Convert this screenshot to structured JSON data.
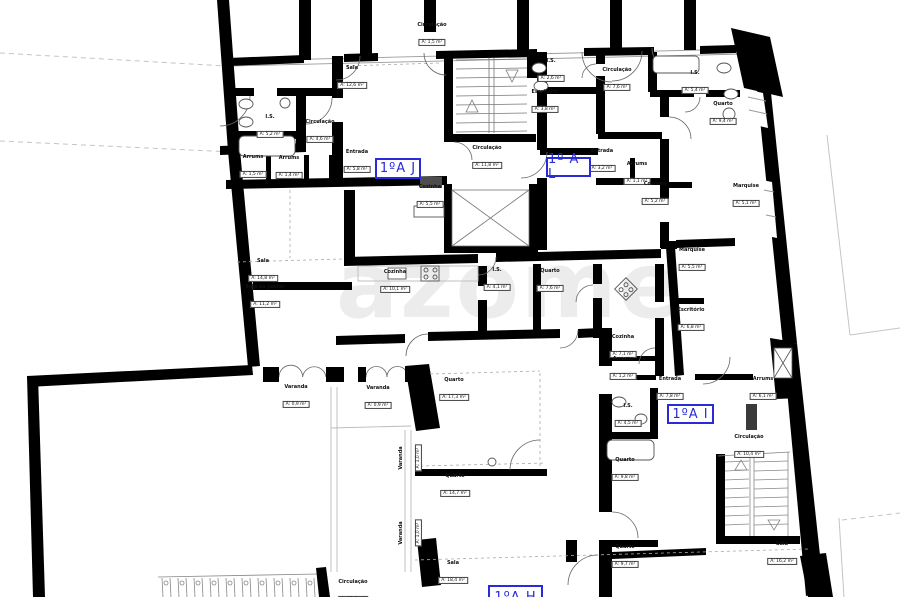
{
  "watermark": "azome",
  "colors": {
    "walls": "#000000",
    "unit_accent": "#2a2ad9",
    "watermark": "#ececec"
  },
  "units": [
    {
      "label": "1ºA J",
      "x": 375,
      "y": 158,
      "w": 46,
      "h": 21
    },
    {
      "label": "1º A L",
      "x": 546,
      "y": 157,
      "w": 45,
      "h": 20
    },
    {
      "label": "1ºA I",
      "x": 667,
      "y": 404,
      "w": 47,
      "h": 20
    },
    {
      "label": "1ºA H",
      "x": 488,
      "y": 585,
      "w": 55,
      "h": 24
    }
  ],
  "rooms": [
    {
      "name": "Circulação",
      "area": "A: 1,5 m²",
      "x": 432,
      "y": 35
    },
    {
      "name": "Sala",
      "area": "A: 12,6 m²",
      "x": 352,
      "y": 78
    },
    {
      "name": "I.S.",
      "area": "A: 5,2 m²",
      "x": 270,
      "y": 127
    },
    {
      "name": "Circulação",
      "area": "A: 4,6 m²",
      "x": 320,
      "y": 132
    },
    {
      "name": "Arrums",
      "area": "A: 1,5 m²",
      "x": 253,
      "y": 167
    },
    {
      "name": "Arrums",
      "area": "A: 1,4 m²",
      "x": 289,
      "y": 168
    },
    {
      "name": "Entrada",
      "area": "A: 5,8 m²",
      "x": 357,
      "y": 162
    },
    {
      "name": "Cozinha",
      "area": "A: 5,5 m²",
      "x": 430,
      "y": 197
    },
    {
      "name": "Circulação",
      "area": "A: 11,8 m²",
      "x": 487,
      "y": 158
    },
    {
      "name": "I.S.",
      "area": "A: 2,6 m²",
      "x": 551,
      "y": 71
    },
    {
      "name": "Circulação",
      "area": "A: 7,6 m²",
      "x": 617,
      "y": 80
    },
    {
      "name": "Escritório",
      "area": "A: 3,8 m²",
      "x": 545,
      "y": 102
    },
    {
      "name": "I.S.",
      "area": "A: 5,4 m²",
      "x": 695,
      "y": 83
    },
    {
      "name": "Quarto",
      "area": "A: 9,4 m²",
      "x": 723,
      "y": 114
    },
    {
      "name": "Entrada",
      "area": "A: 3,2 m²",
      "x": 602,
      "y": 161
    },
    {
      "name": "Arrums",
      "area": "A: 1,1 m²",
      "x": 637,
      "y": 174
    },
    {
      "name": "Cozinha",
      "area": "A: 5,2 m²",
      "x": 655,
      "y": 194
    },
    {
      "name": "Marquise",
      "area": "A: 5,1 m²",
      "x": 746,
      "y": 196
    },
    {
      "name": "Sala",
      "area": "A: 14,8 m²",
      "x": 263,
      "y": 271
    },
    {
      "name": "Sala de Jantar",
      "area": "A: 11,2 m²",
      "x": 265,
      "y": 297
    },
    {
      "name": "Cozinha",
      "area": "A: 10,1 m²",
      "x": 395,
      "y": 282
    },
    {
      "name": "I.S.",
      "area": "A: 4,1 m²",
      "x": 497,
      "y": 280
    },
    {
      "name": "Quarto",
      "area": "A: 7,6 m²",
      "x": 550,
      "y": 281
    },
    {
      "name": "Marquise",
      "area": "A: 5,5 m²",
      "x": 692,
      "y": 260
    },
    {
      "name": "Escritório",
      "area": "A: 6,8 m²",
      "x": 691,
      "y": 320
    },
    {
      "name": "Cozinha",
      "area": "A: 7,1 m²",
      "x": 623,
      "y": 347
    },
    {
      "name": "Arrums",
      "area": "A: 1,2 m²",
      "x": 623,
      "y": 369
    },
    {
      "name": "Entrada",
      "area": "A: 7,8 m²",
      "x": 670,
      "y": 389
    },
    {
      "name": "Arrums",
      "area": "A: 6,1 m²",
      "x": 763,
      "y": 389
    },
    {
      "name": "I.S.",
      "area": "A: 4,5 m²",
      "x": 628,
      "y": 416
    },
    {
      "name": "Circulação",
      "area": "A: 10,4 m²",
      "x": 749,
      "y": 447
    },
    {
      "name": "Quarto",
      "area": "A: 9,8 m²",
      "x": 625,
      "y": 470
    },
    {
      "name": "Quarto",
      "area": "A: 9,7 m²",
      "x": 625,
      "y": 557
    },
    {
      "name": "Sala",
      "area": "A: 16,2 m²",
      "x": 782,
      "y": 554
    },
    {
      "name": "Quarto",
      "area": "A: 17,3 m²",
      "x": 454,
      "y": 390
    },
    {
      "name": "Quarto",
      "area": "A: 14,7 m²",
      "x": 455,
      "y": 486
    },
    {
      "name": "Sala",
      "area": "A: 18,4 m²",
      "x": 453,
      "y": 573
    },
    {
      "name": "Circulação",
      "area": "A: 12,6 m²",
      "x": 353,
      "y": 592
    },
    {
      "name": "Varanda",
      "area": "A: 0,9 m²",
      "x": 296,
      "y": 397
    },
    {
      "name": "Varanda",
      "area": "A: 0,9 m²",
      "x": 378,
      "y": 398
    },
    {
      "name": "Varanda",
      "area": "A: 1,0 m²",
      "x": 411,
      "y": 458,
      "vertical": true
    },
    {
      "name": "Varanda",
      "area": "A: 1,0 m²",
      "x": 411,
      "y": 533,
      "vertical": true
    }
  ]
}
